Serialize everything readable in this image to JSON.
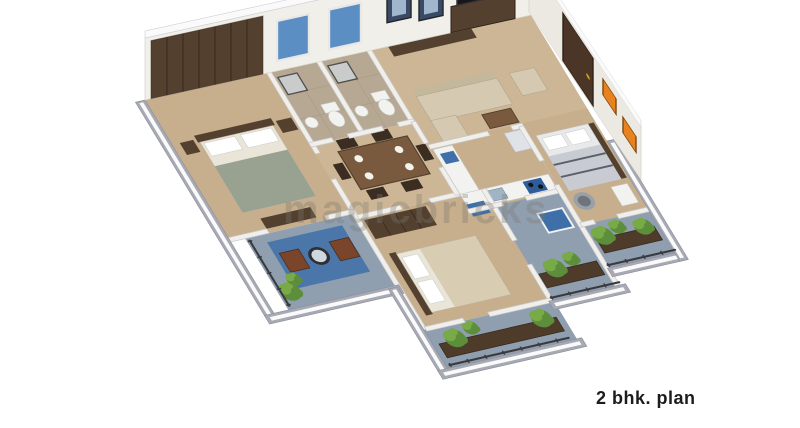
{
  "caption": {
    "text": "2 bhk. plan"
  },
  "watermark": {
    "text": "magicbricks"
  },
  "palette": {
    "background": "#ffffff",
    "floor_wood": "#c7ae8c",
    "floor_light": "#cdb695",
    "floor_tile": "#b7a893",
    "floor_balcony": "#8f9fb0",
    "mat_blue": "#3f6fa8",
    "wall_face": "#f1efe9",
    "wall_top": "#fafafa",
    "wall_edge": "#c9cad0",
    "wall_gray": "#a7aab4",
    "wood_dark": "#54402f",
    "wood_mid": "#7a5a3e",
    "window_blue": "#5b8ec3",
    "screen_black": "#17171a",
    "bed_green": "#99a191",
    "bed_cream": "#e9e5d9",
    "bed_beige": "#d8cdb2",
    "bed_white": "#e8e9ea",
    "sofa_beige": "#d5cab1",
    "plant_green": "#5d8e3b",
    "plant_light": "#78ab46",
    "soil_brown": "#4e3b2a",
    "railing_dark": "#3a3a3e",
    "chair_brown": "#7a452a",
    "picture_orange": "#e8821e",
    "door_brown": "#4a3526",
    "fixture_white": "#f2f2f0",
    "steel_gray": "#9fb4c4",
    "caption_color": "#1c1c1c",
    "watermark_color": "rgba(125,120,110,0.33)"
  }
}
